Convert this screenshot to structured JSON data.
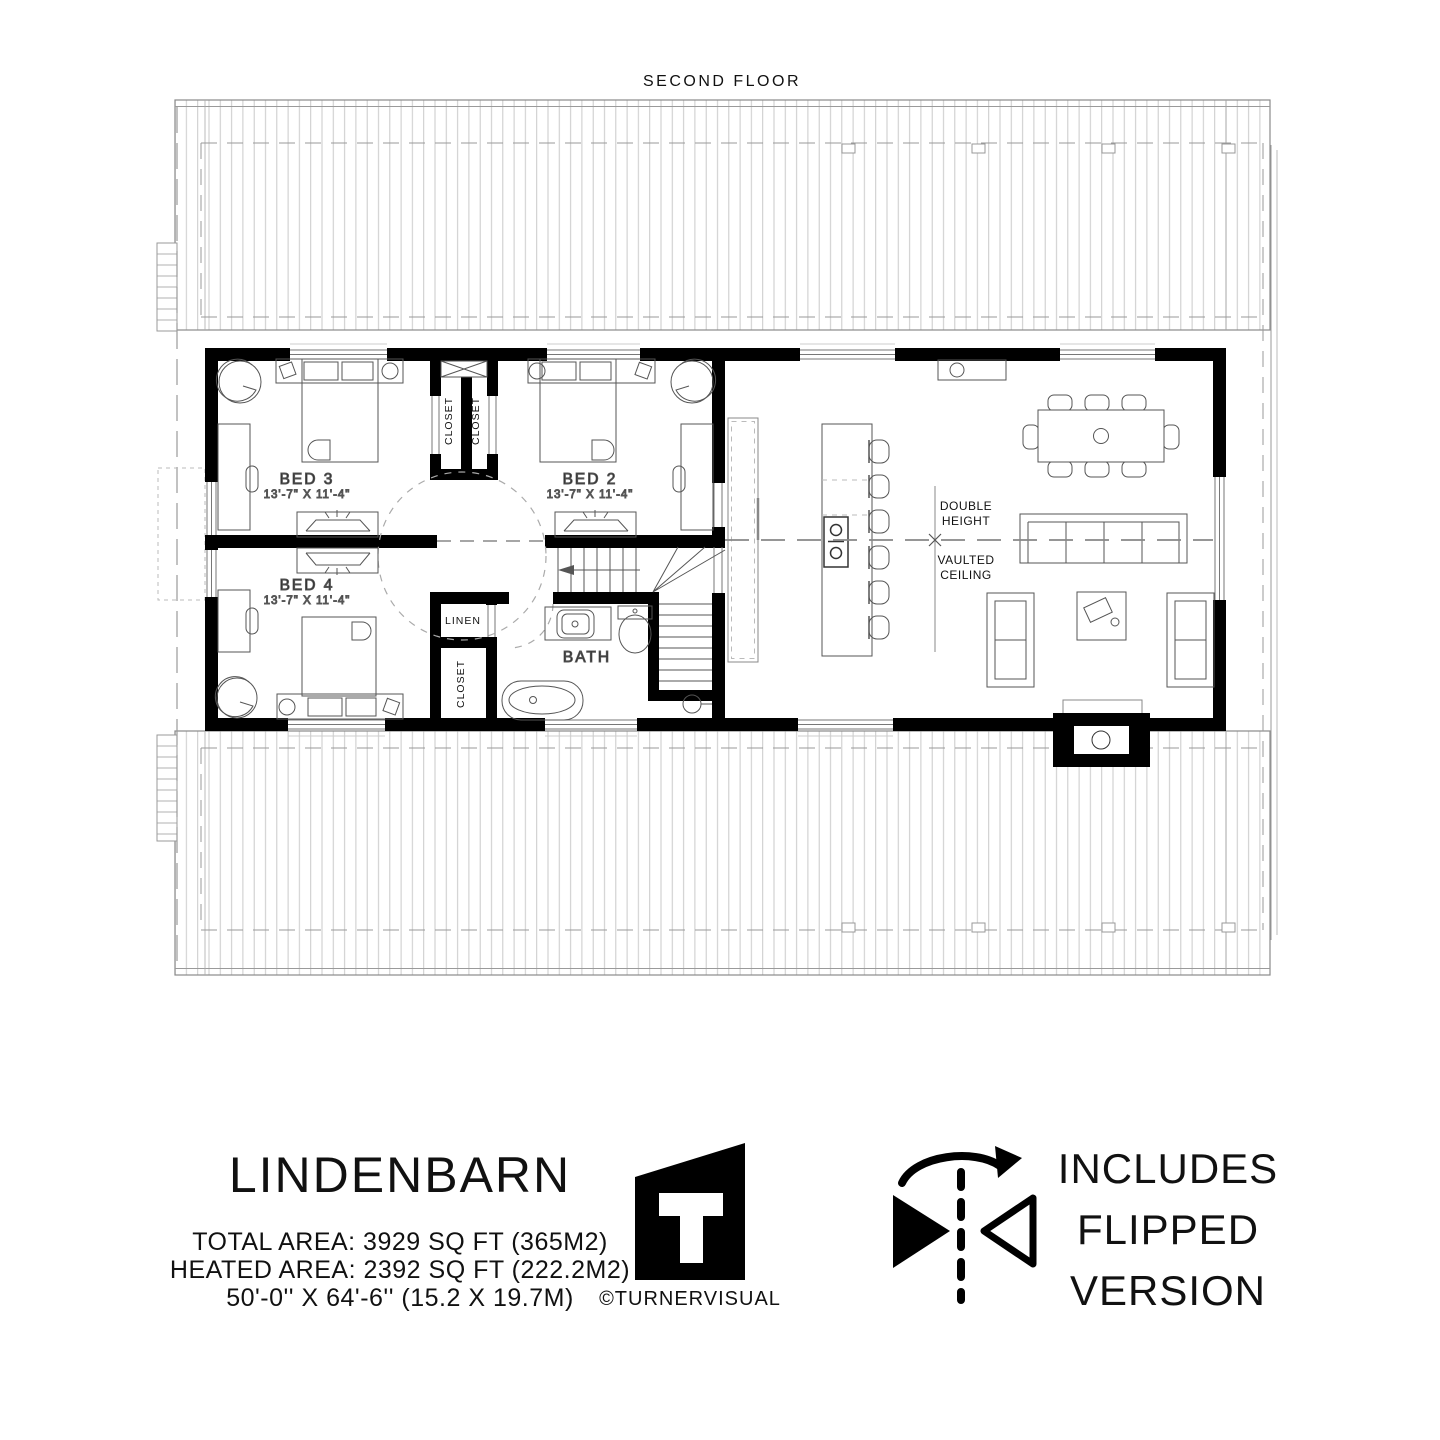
{
  "plan": {
    "title": "SECOND FLOOR",
    "rooms": {
      "bed3": {
        "name": "BED 3",
        "dims": "13'-7\" X 11'-4\""
      },
      "bed2": {
        "name": "BED 2",
        "dims": "13'-7\" X 11'-4\""
      },
      "bed4": {
        "name": "BED 4",
        "dims": "13'-7\" X 11'-4\""
      }
    },
    "labels": {
      "closet": "CLOSET",
      "linen": "LINEN",
      "bath": "BATH"
    },
    "annotation": {
      "l1": "DOUBLE",
      "l2": "HEIGHT",
      "l3": "VAULTED",
      "l4": "CEILING"
    }
  },
  "footer": {
    "name": "LINDENBARN",
    "total": "TOTAL AREA: 3929 SQ FT (365M2)",
    "heated": "HEATED AREA: 2392 SQ FT (222.2M2)",
    "size": "50'-0'' X 64'-6'' (15.2 X 19.7M)",
    "credit": "©TURNERVISUAL",
    "flipped": [
      "INCLUDES",
      "FLIPPED",
      "VERSION"
    ]
  },
  "colors": {
    "ink": "#111111",
    "wall": "#000000",
    "furniture": "#555555",
    "light": "#9a9a9a",
    "hatch": "#c9c9c9"
  }
}
